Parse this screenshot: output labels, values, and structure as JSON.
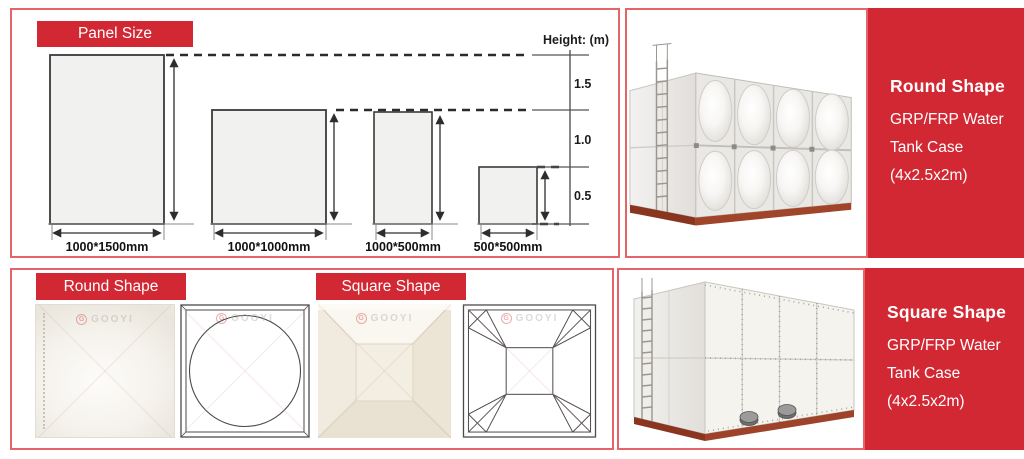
{
  "brand": {
    "watermark": "GOOYI"
  },
  "colors": {
    "accent_red": "#d22833",
    "border_pink": "#e4646a",
    "base_brown": "#9e432a"
  },
  "top_row": {
    "panel_size_label": "Panel Size",
    "diagram": {
      "axis_title": "Height: (m)",
      "axis_ticks": [
        "1.5",
        "1.0",
        "0.5"
      ],
      "panel_labels": [
        "1000*1500mm",
        "1000*1000mm",
        "1000*500mm",
        "500*500mm"
      ]
    },
    "info": {
      "title": "Round Shape",
      "line1": "GRP/FRP Water",
      "line2": "Tank Case",
      "line3": "(4x2.5x2m)"
    }
  },
  "bottom_row": {
    "round_shape_label": "Round Shape",
    "square_shape_label": "Square Shape",
    "info": {
      "title": "Square Shape",
      "line1": "GRP/FRP Water",
      "line2": "Tank Case",
      "line3": "(4x2.5x2m)"
    }
  }
}
